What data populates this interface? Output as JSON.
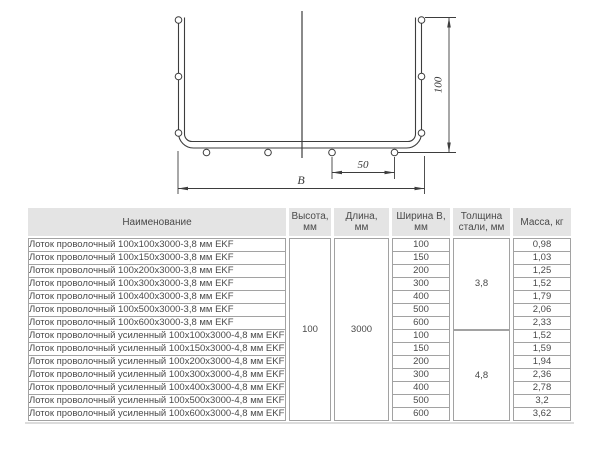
{
  "drawing": {
    "dim_height": "100",
    "dim_spacing": "50",
    "dim_width": "B"
  },
  "table": {
    "headers": [
      "Наименование",
      "Высота,\nмм",
      "Длина,\nмм",
      "Ширина В,\nмм",
      "Толщина\nстали, мм",
      "Масса, кг"
    ],
    "merged": {
      "height_mm": "100",
      "length_mm": "3000",
      "thickness_groups": [
        "3,8",
        "4,8"
      ]
    },
    "rows": [
      {
        "name": "Лоток проволочный 100х100х3000-3,8 мм EKF",
        "width_mm": "100",
        "mass_kg": "0,98"
      },
      {
        "name": "Лоток проволочный 100х150х3000-3,8 мм EKF",
        "width_mm": "150",
        "mass_kg": "1,03"
      },
      {
        "name": "Лоток проволочный 100х200х3000-3,8 мм EKF",
        "width_mm": "200",
        "mass_kg": "1,25"
      },
      {
        "name": "Лоток проволочный 100х300х3000-3,8 мм EKF",
        "width_mm": "300",
        "mass_kg": "1,52"
      },
      {
        "name": "Лоток проволочный 100х400х3000-3,8 мм EKF",
        "width_mm": "400",
        "mass_kg": "1,79"
      },
      {
        "name": "Лоток проволочный 100х500х3000-3,8 мм EKF",
        "width_mm": "500",
        "mass_kg": "2,06"
      },
      {
        "name": "Лоток проволочный 100х600х3000-3,8 мм EKF",
        "width_mm": "600",
        "mass_kg": "2,33"
      },
      {
        "name": "Лоток проволочный усиленный 100х100х3000-4,8 мм EKF",
        "width_mm": "100",
        "mass_kg": "1,52"
      },
      {
        "name": "Лоток проволочный усиленный 100х150х3000-4,8 мм EKF",
        "width_mm": "150",
        "mass_kg": "1,59"
      },
      {
        "name": "Лоток проволочный усиленный 100х200х3000-4,8 мм EKF",
        "width_mm": "200",
        "mass_kg": "1,94"
      },
      {
        "name": "Лоток проволочный усиленный 100х300х3000-4,8 мм EKF",
        "width_mm": "300",
        "mass_kg": "2,36"
      },
      {
        "name": "Лоток проволочный усиленный 100х400х3000-4,8 мм EKF",
        "width_mm": "400",
        "mass_kg": "2,78"
      },
      {
        "name": "Лоток проволочный усиленный 100х500х3000-4,8 мм EKF",
        "width_mm": "500",
        "mass_kg": "3,2"
      },
      {
        "name": "Лоток проволочный усиленный 100х600х3000-4,8 мм EKF",
        "width_mm": "600",
        "mass_kg": "3,62"
      }
    ]
  }
}
